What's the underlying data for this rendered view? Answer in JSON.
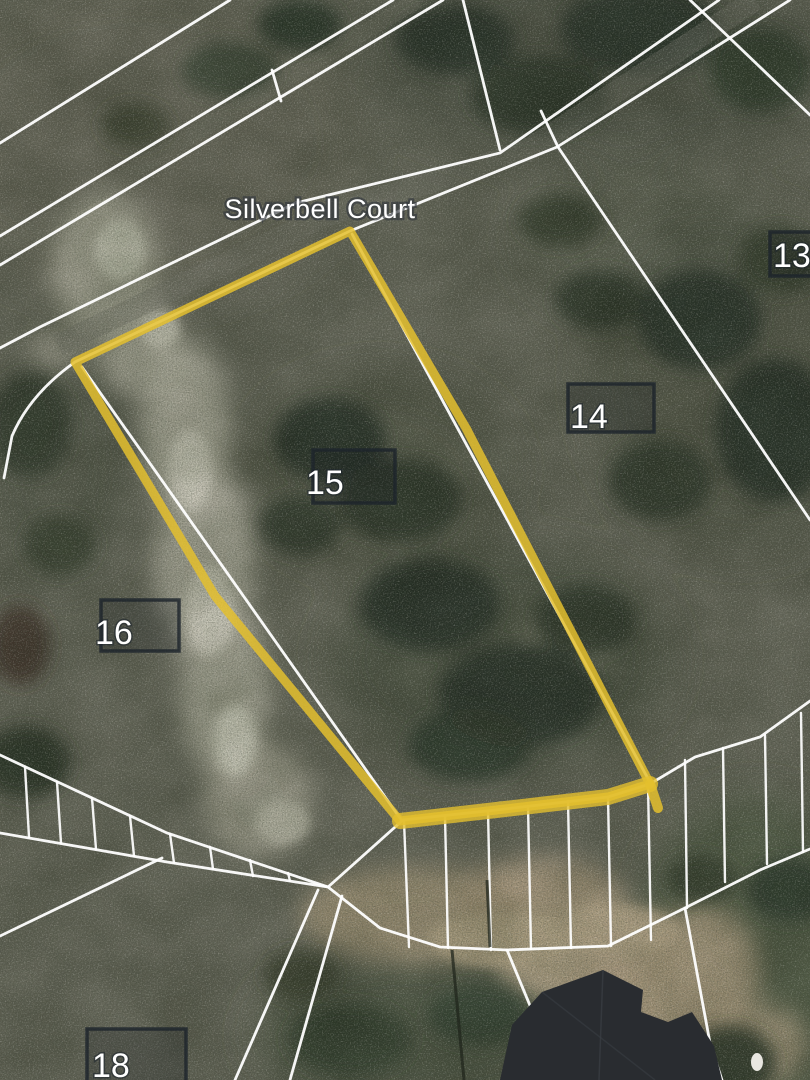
{
  "map": {
    "imagery": "satellite",
    "street": {
      "label": "Silverbell Court"
    },
    "lots": [
      {
        "number": "13"
      },
      {
        "number": "14"
      },
      {
        "number": "15"
      },
      {
        "number": "16"
      },
      {
        "number": "18"
      }
    ],
    "highlighted_parcel": {
      "lot": "15",
      "outline_color": "#e4bf2e"
    },
    "colors": {
      "boundary_lines": "#ffffff",
      "lot_marker_box": "#1d242c",
      "lot_number_text": "#ffffff",
      "street_label_text": "#ffffff",
      "terrain_base": "#6c6d60"
    }
  }
}
